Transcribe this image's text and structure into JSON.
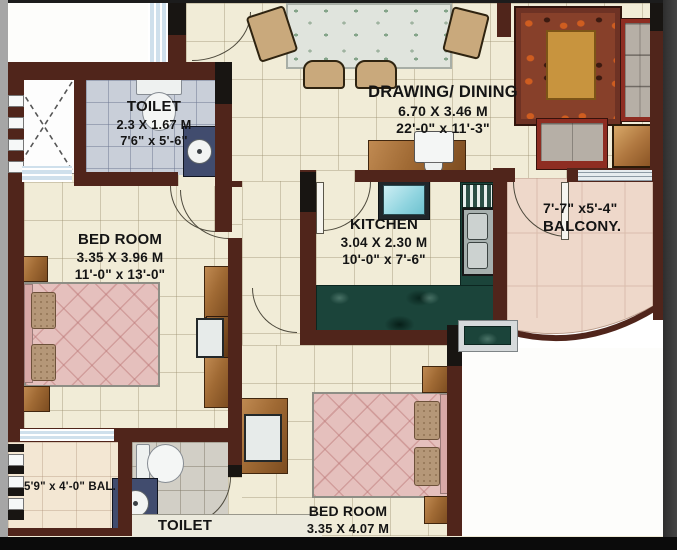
{
  "plan_title": "apartment-floor-plan",
  "rooms": {
    "toilet_top": {
      "name": "TOILET",
      "dim_m": "2.3 X 1.67 M",
      "dim_ft": "7'6\" x 5'-6\""
    },
    "drawing_dining": {
      "name": "DRAWING/ DINING",
      "dim_m": "6.70 X 3.46 M",
      "dim_ft": "22'-0\" x 11'-3\""
    },
    "kitchen": {
      "name": "KITCHEN",
      "dim_m": "3.04 X 2.30 M",
      "dim_ft": "10'-0\" x 7'-6\""
    },
    "bedroom_top": {
      "name": "BED ROOM",
      "dim_m": "3.35 X 3.96 M",
      "dim_ft": "11'-0\" x 13'-0\""
    },
    "balcony_right": {
      "dim_ft": "7'-7\" x5'-4\"",
      "name": "BALCONY."
    },
    "bedroom_bottom": {
      "name": "BED ROOM",
      "dim_m": "3.35 X 4.07 M",
      "dim_ft": "11'-0\" x 13'-4\""
    },
    "toilet_bottom": {
      "name": "TOILET"
    },
    "balcony_left": {
      "label": "5'9\" x 4'-0\" BAL."
    }
  },
  "colors": {
    "wall": "#50251b",
    "floor": "#f1ecd7",
    "toilet_floor": "#c9cfd9",
    "kitchen_counter": "#1b443a",
    "bed": "#e5c0bd",
    "balcony_floor": "#eed8ca",
    "rug_accent": "#cf5d20",
    "text": "#141414"
  }
}
